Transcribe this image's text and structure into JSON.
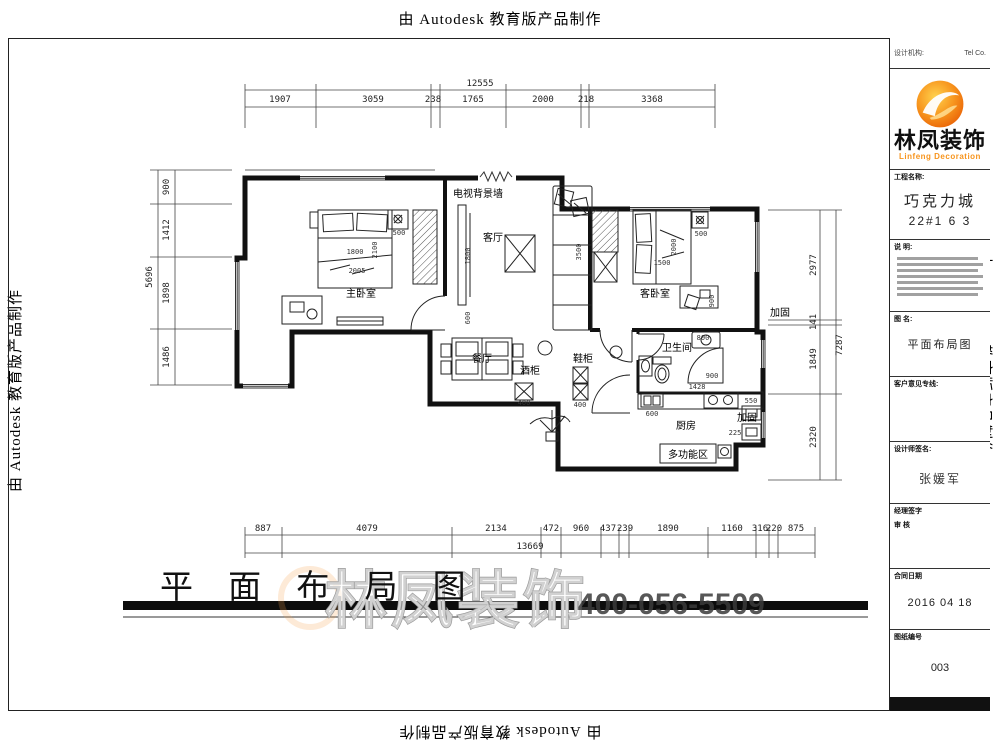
{
  "banners": {
    "top": "由 Autodesk 教育版产品制作",
    "bottom": "由 Autodesk 教育版产品制作",
    "left": "由 Autodesk 教育版产品制作",
    "right": "由 Autodesk 教育版产品制作"
  },
  "title": {
    "text": "平 面 布 局 图"
  },
  "watermark": {
    "brand": "林凤装饰",
    "phone": "400-056-5509"
  },
  "titleblock": {
    "header_left": "设计机构:",
    "header_right": "Tel   Co.",
    "brand": "林凤装饰",
    "brand_en": "Linfeng Decoration",
    "project_label": "工程名称:",
    "project_name": "巧克力城",
    "project_unit": "22#1 6 3",
    "desc_label": "说 明:",
    "drawing_label": "图 名:",
    "drawing_name": "平面布局图",
    "hotline_label": "客户意见专线:",
    "designer_label": "设计师签名:",
    "designer_name": "张媛军",
    "manager_label": "经理签字",
    "review_label": "审  核",
    "date_label": "合同日期",
    "date_value": "2016 04 18",
    "sheet_label": "图纸编号",
    "sheet_value": "003"
  },
  "dimensions": {
    "top": {
      "total": {
        "t": "12555",
        "x": 480,
        "y": 86
      },
      "segments": [
        {
          "t": "1907",
          "x": 280,
          "y": 102
        },
        {
          "t": "3059",
          "x": 373,
          "y": 102
        },
        {
          "t": "238",
          "x": 433,
          "y": 102
        },
        {
          "t": "1765",
          "x": 473,
          "y": 102
        },
        {
          "t": "2000",
          "x": 543,
          "y": 102
        },
        {
          "t": "218",
          "x": 586,
          "y": 102
        },
        {
          "t": "3368",
          "x": 652,
          "y": 102
        }
      ]
    },
    "bottom": {
      "total": {
        "t": "13669",
        "x": 530,
        "y": 549
      },
      "segments": [
        {
          "t": "887",
          "x": 263,
          "y": 531
        },
        {
          "t": "4079",
          "x": 367,
          "y": 531
        },
        {
          "t": "2134",
          "x": 496,
          "y": 531
        },
        {
          "t": "472",
          "x": 551,
          "y": 531
        },
        {
          "t": "960",
          "x": 581,
          "y": 531
        },
        {
          "t": "437",
          "x": 608,
          "y": 531
        },
        {
          "t": "239",
          "x": 625,
          "y": 531
        },
        {
          "t": "1890",
          "x": 668,
          "y": 531
        },
        {
          "t": "1160",
          "x": 732,
          "y": 531
        },
        {
          "t": "316",
          "x": 760,
          "y": 531
        },
        {
          "t": "220",
          "x": 774,
          "y": 531
        },
        {
          "t": "875",
          "x": 796,
          "y": 531
        }
      ]
    },
    "left": {
      "total": {
        "t": "5696",
        "x": 152,
        "y": 277,
        "r": -90
      },
      "segments": [
        {
          "t": "900",
          "x": 169,
          "y": 187,
          "r": -90
        },
        {
          "t": "1412",
          "x": 169,
          "y": 230,
          "r": -90
        },
        {
          "t": "1898",
          "x": 169,
          "y": 293,
          "r": -90
        },
        {
          "t": "1486",
          "x": 169,
          "y": 357,
          "r": -90
        }
      ]
    },
    "right": {
      "total": {
        "t": "7287",
        "x": 842,
        "y": 345,
        "r": -90
      },
      "segments": [
        {
          "t": "2977",
          "x": 816,
          "y": 265,
          "r": -90
        },
        {
          "t": "141",
          "x": 816,
          "y": 322,
          "r": -90
        },
        {
          "t": "1849",
          "x": 816,
          "y": 359,
          "r": -90
        },
        {
          "t": "2320",
          "x": 816,
          "y": 437,
          "r": -90
        }
      ]
    }
  },
  "plan": {
    "room_labels": [
      {
        "t": "主卧室",
        "x": 361,
        "y": 297,
        "s": 11
      },
      {
        "t": "客厅",
        "x": 493,
        "y": 241,
        "s": 11
      },
      {
        "t": "客卧室",
        "x": 655,
        "y": 297,
        "s": 11
      },
      {
        "t": "卫生间",
        "x": 677,
        "y": 351,
        "s": 10
      },
      {
        "t": "厨房",
        "x": 686,
        "y": 429,
        "s": 10
      },
      {
        "t": "多功能区",
        "x": 688,
        "y": 458,
        "s": 9
      },
      {
        "t": "餐厅",
        "x": 482,
        "y": 362,
        "s": 8
      },
      {
        "t": "酒柜",
        "x": 530,
        "y": 374,
        "s": 7
      },
      {
        "t": "鞋柜",
        "x": 583,
        "y": 362,
        "s": 7
      },
      {
        "t": "电视背景墙",
        "x": 478,
        "y": 197,
        "s": 6
      },
      {
        "t": "加固",
        "x": 780,
        "y": 316,
        "s": 9
      },
      {
        "t": "加固",
        "x": 747,
        "y": 421,
        "s": 8
      }
    ],
    "inner_dims": [
      {
        "t": "1800",
        "x": 355,
        "y": 254
      },
      {
        "t": "2005",
        "x": 357,
        "y": 273
      },
      {
        "t": "2100",
        "x": 377,
        "y": 250,
        "r": -90
      },
      {
        "t": "500",
        "x": 399,
        "y": 235
      },
      {
        "t": "1800",
        "x": 470,
        "y": 256,
        "r": -90
      },
      {
        "t": "600",
        "x": 470,
        "y": 318,
        "r": -90
      },
      {
        "t": "3500",
        "x": 581,
        "y": 252,
        "r": -90
      },
      {
        "t": "1500",
        "x": 662,
        "y": 265
      },
      {
        "t": "2000",
        "x": 676,
        "y": 247,
        "r": -90
      },
      {
        "t": "500",
        "x": 701,
        "y": 236
      },
      {
        "t": "900",
        "x": 714,
        "y": 301,
        "r": -90
      },
      {
        "t": "800",
        "x": 703,
        "y": 340
      },
      {
        "t": "900",
        "x": 712,
        "y": 378
      },
      {
        "t": "1428",
        "x": 697,
        "y": 389
      },
      {
        "t": "600",
        "x": 652,
        "y": 416
      },
      {
        "t": "550",
        "x": 751,
        "y": 403
      },
      {
        "t": "225",
        "x": 735,
        "y": 435
      },
      {
        "t": "400",
        "x": 524,
        "y": 405
      },
      {
        "t": "400",
        "x": 580,
        "y": 407
      }
    ]
  }
}
